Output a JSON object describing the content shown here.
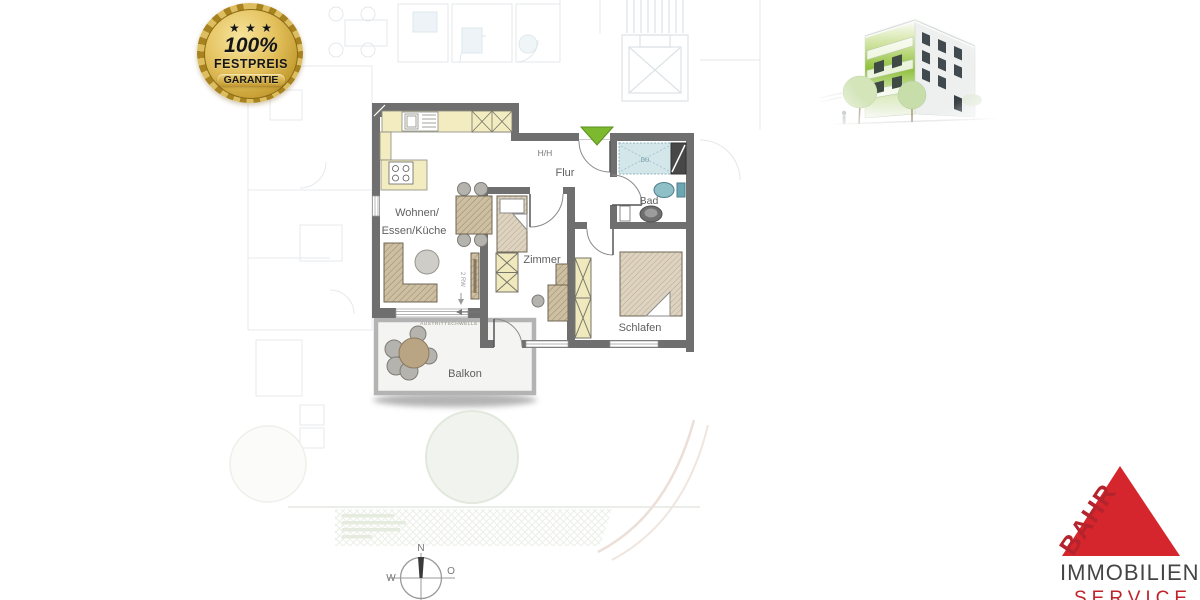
{
  "badge": {
    "stars": "★ ★ ★",
    "percent": "100%",
    "festpreis": "FESTPREIS",
    "garantie": "GARANTIE"
  },
  "floorplan": {
    "rooms": {
      "wohnen_line1": "Wohnen/",
      "wohnen_line2": "Essen/Küche",
      "flur": "Flur",
      "bad": "Bad",
      "zimmer": "Zimmer",
      "schlafen": "Schlafen",
      "balkon": "Balkon"
    },
    "annotations": {
      "threshold": "AUSTRITTSCHWELLE",
      "handrail": "H/H",
      "rw": "2 RW",
      "shower": "DU"
    }
  },
  "compass": {
    "north": "N",
    "west": "W",
    "east": "O"
  },
  "logo": {
    "brand": "BAHR",
    "line1": "IMMOBILIEN",
    "line2": "SERVICE"
  },
  "colors": {
    "brand_red": "#c2232b",
    "badge_gold": "#d4ab45",
    "entrance_green": "#7cb92e",
    "wall_gray": "#6f6f6f",
    "counter_cream": "#f2ecc0",
    "furniture_tan": "#cdbfa2",
    "shower_blue": "#d3e6ea"
  }
}
